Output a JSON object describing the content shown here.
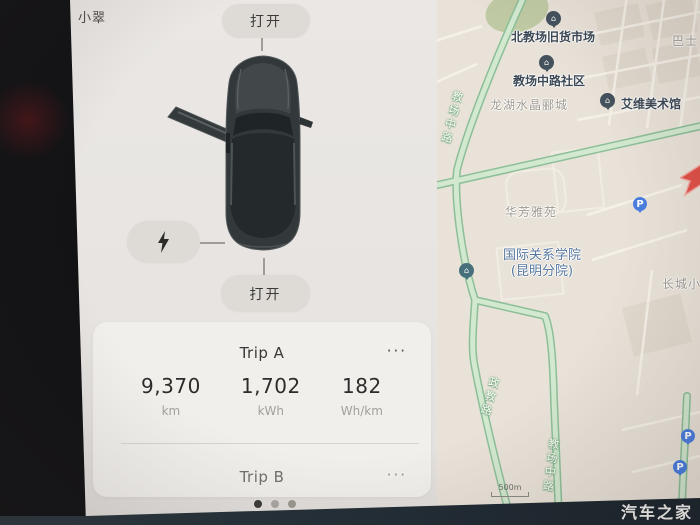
{
  "vehicle_panel": {
    "car_name": "小翠",
    "frunk_button_label": "打开",
    "trunk_button_label": "打开",
    "charge_icon": "lightning-bolt",
    "page_dots_count": 3,
    "active_dot_index": 0
  },
  "trip_card": {
    "trip_a": {
      "title": "Trip A",
      "menu": "···",
      "stats": [
        {
          "value": "9,370",
          "unit": "km"
        },
        {
          "value": "1,702",
          "unit": "kWh"
        },
        {
          "value": "182",
          "unit": "Wh/km"
        }
      ]
    },
    "trip_b": {
      "title": "Trip B",
      "menu": "···"
    }
  },
  "map": {
    "poi_labels": [
      "北教场旧货市场",
      "教场中路社区",
      "艾维美术馆"
    ],
    "school_label_line1": "国际关系学院",
    "school_label_line2": "(昆明分院)",
    "area_labels": [
      "龙湖水晶郦城",
      "华芳雅苑",
      "巴士",
      "长城小"
    ],
    "road_labels": [
      "教场中路",
      "政教路",
      "教场中路"
    ],
    "parking_label": "P",
    "scale_label": "500m",
    "poi_glyph": "⌂"
  },
  "watermark": "汽车之家",
  "colors": {
    "road_green_edge": "#8cbf98",
    "road_green_fill": "#d2e8cf",
    "poi_dark": "#44525e",
    "poi_school": "#47707c",
    "parking_blue": "#4a7de0",
    "destination_red": "#df5048",
    "watermark_bar": "#1d2830"
  }
}
